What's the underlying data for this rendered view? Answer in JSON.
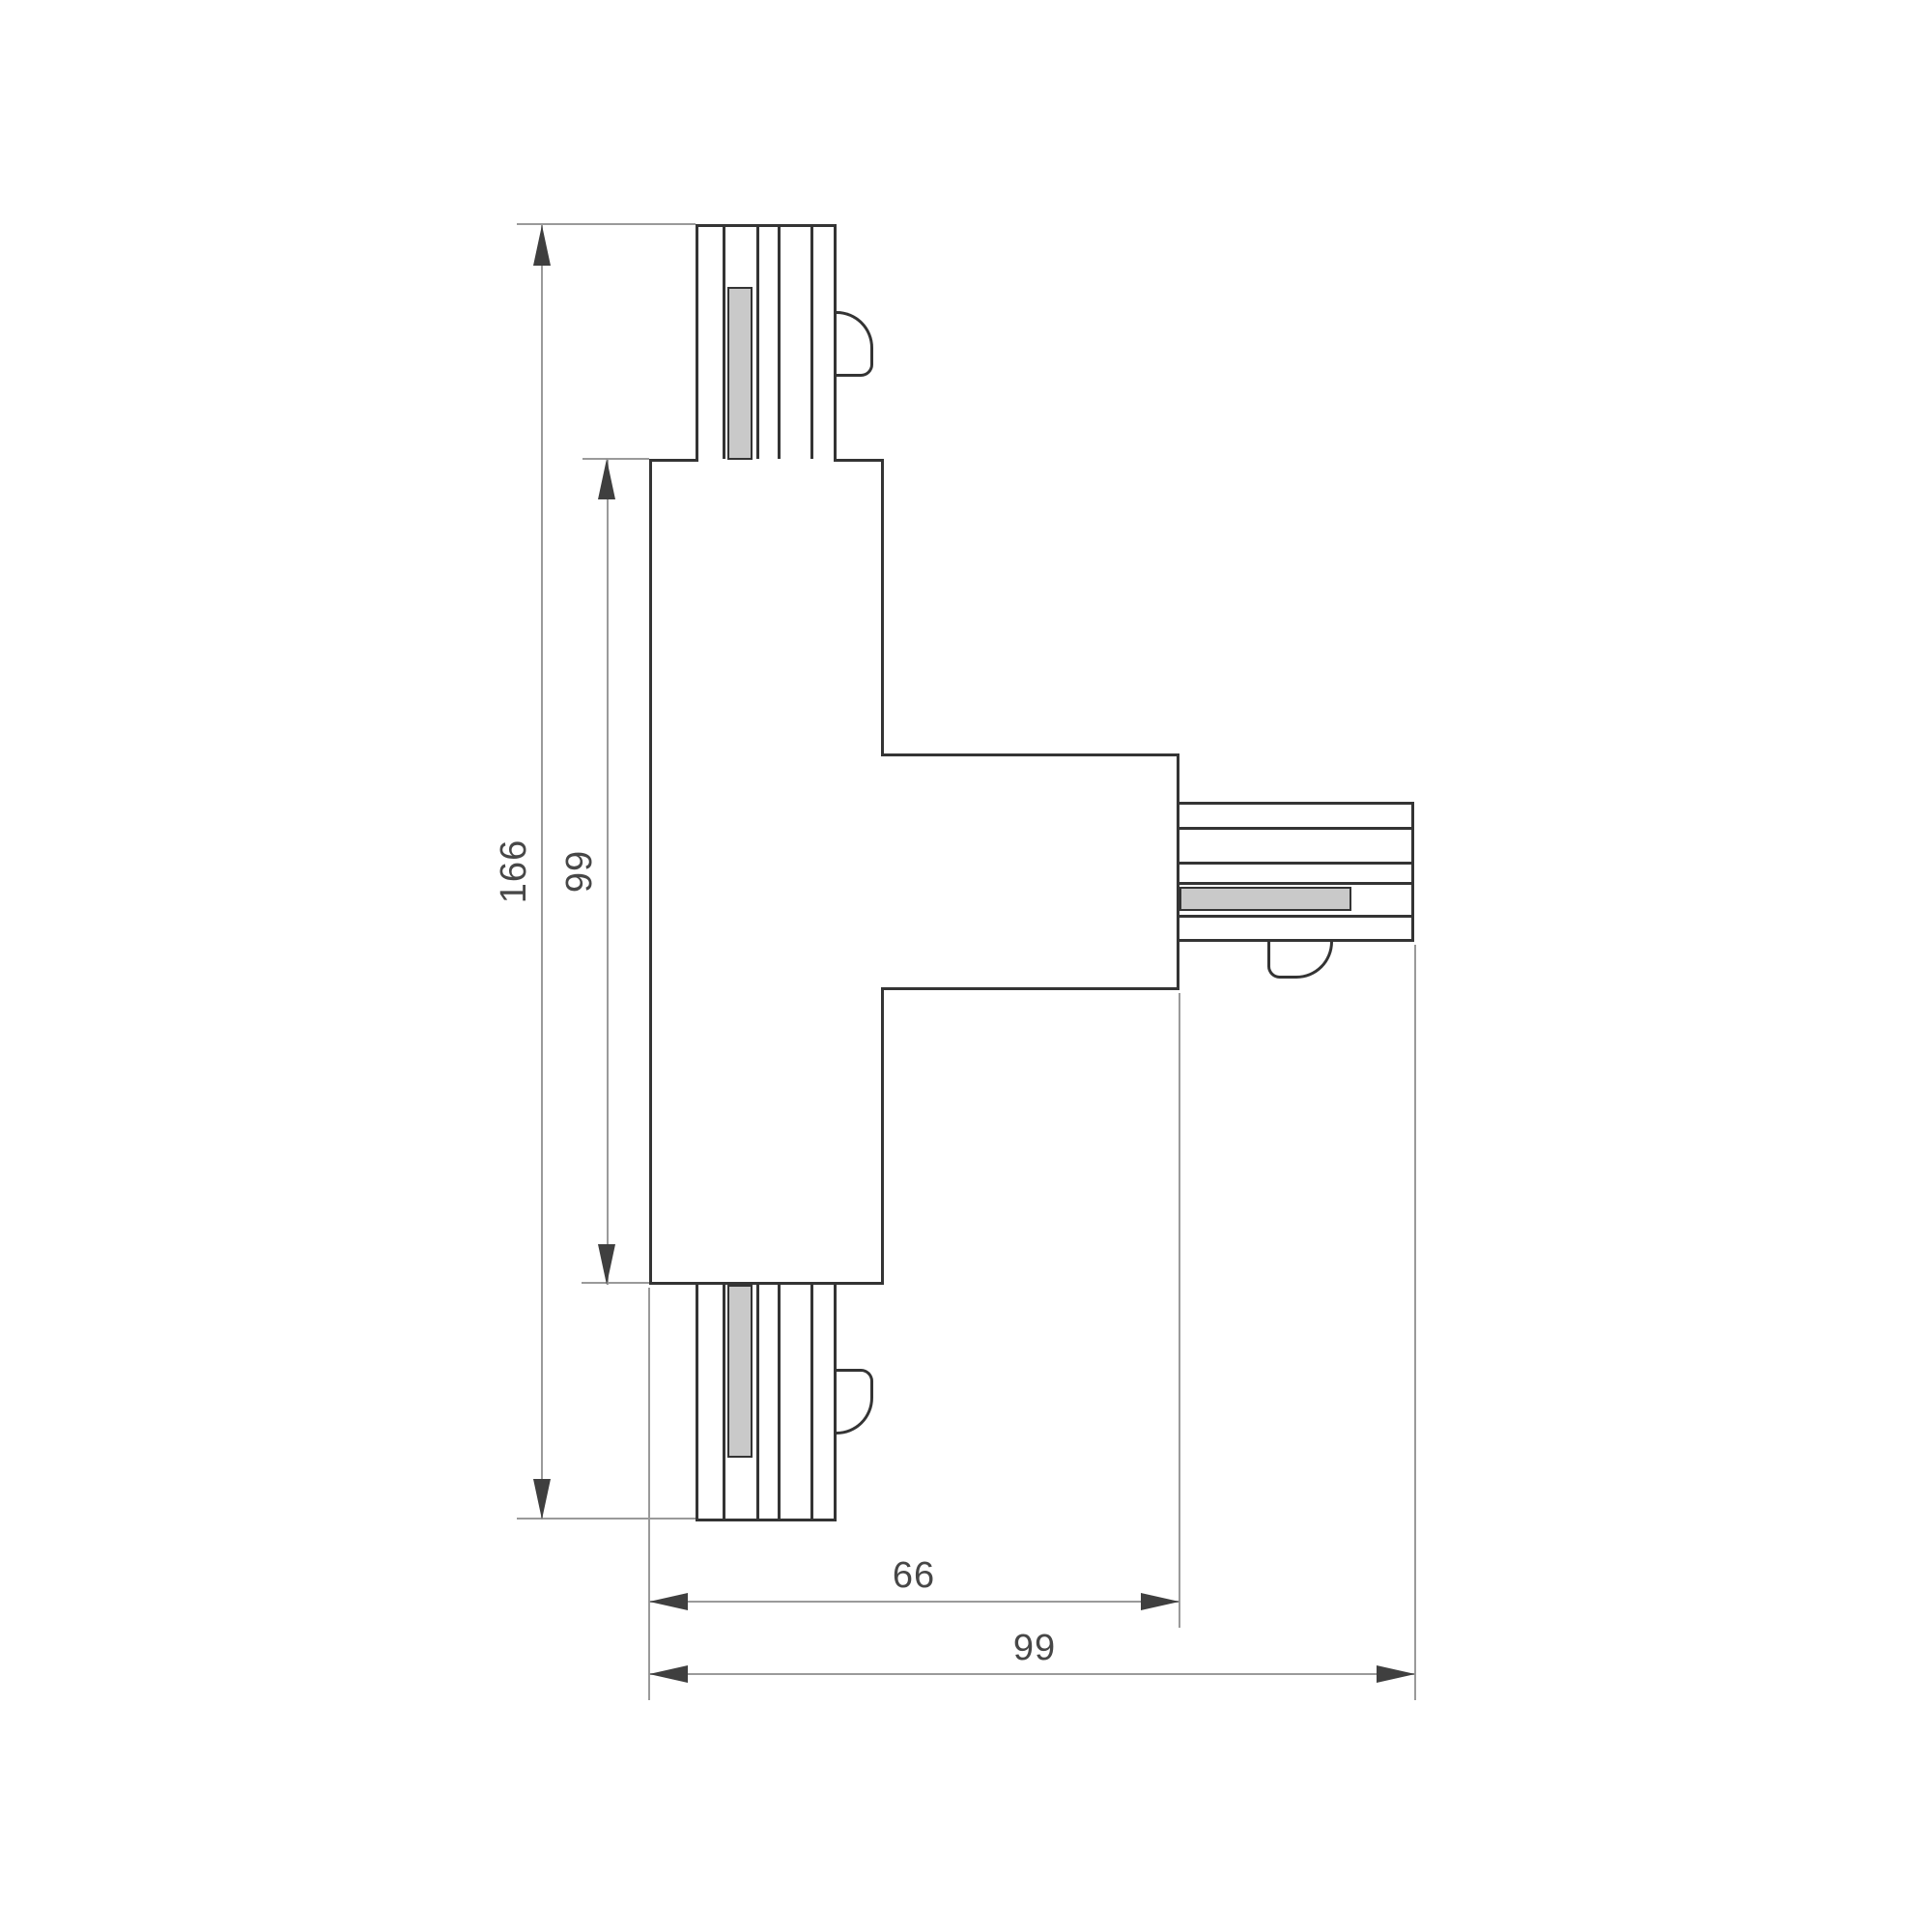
{
  "dimensions": {
    "overall_height": "166",
    "body_height": "99",
    "arm_width": "66",
    "overall_width": "99"
  },
  "colors": {
    "outline": "#343434",
    "contact_fill": "#c9c9c9",
    "dim_line": "#9a9a9a",
    "arrow": "#3f3f3f",
    "text": "#474747",
    "background": "#ffffff"
  }
}
